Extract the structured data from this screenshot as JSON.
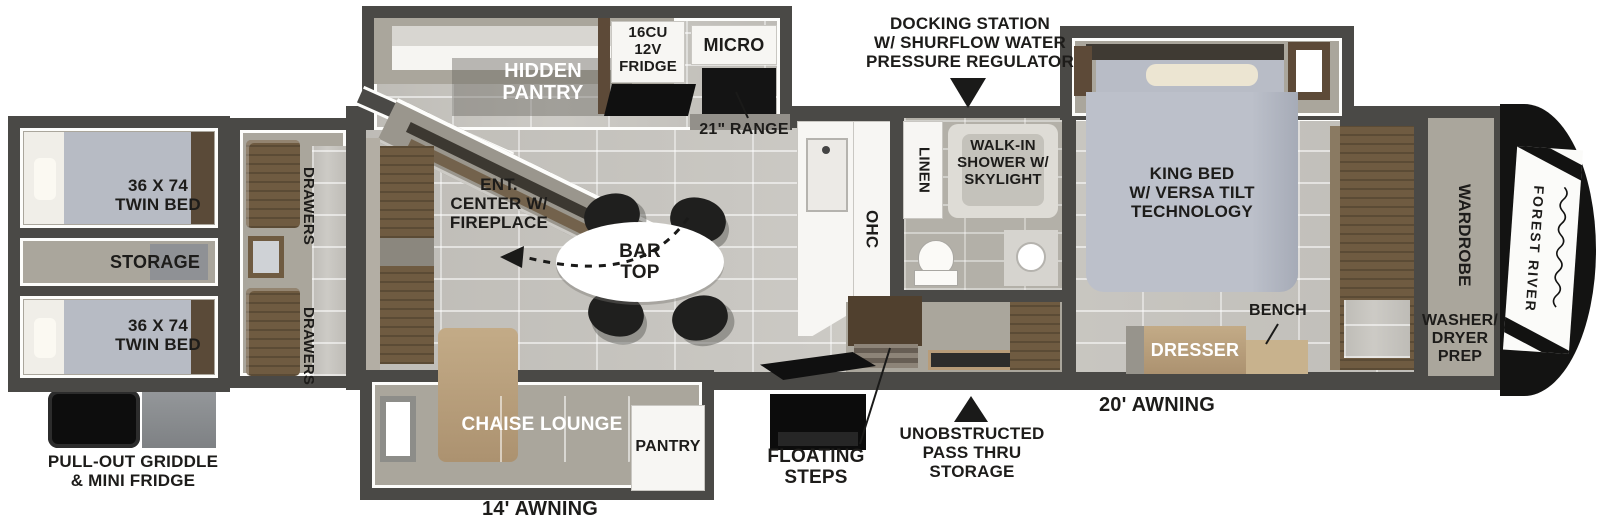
{
  "palette": {
    "wall": "#4a4946",
    "floor_tile": "#c7c5c0",
    "slide_floor": "#aaa69c",
    "wood": "#6f5b41",
    "tan_upholstery": "#b89c78",
    "mattress": "#b7bbc4",
    "appliance_black": "#121212",
    "label_black": "#1d1c1a",
    "label_white": "#ffffff"
  },
  "labels": {
    "twin_bed_top": "36 X 74\nTWIN BED",
    "storage": "STORAGE",
    "twin_bed_bottom": "36 X 74\nTWIN BED",
    "drawers_top": "DRAWERS",
    "drawers_bottom": "DRAWERS",
    "griddle": "PULL-OUT GRIDDLE\n& MINI FRIDGE",
    "hidden_pantry": "HIDDEN\nPANTRY",
    "fridge": "16CU\n12V\nFRIDGE",
    "micro": "MICRO",
    "range": "21\" RANGE",
    "ent_center": "ENT.\nCENTER W/\nFIREPLACE",
    "bar_top": "BAR\nTOP",
    "ohc": "OHC",
    "docking": "DOCKING STATION\nW/ SHURFLOW WATER\nPRESSURE REGULATOR",
    "linen": "LINEN",
    "shower": "WALK-IN\nSHOWER W/\nSKYLIGHT",
    "king_bed": "KING BED\nW/ VERSA TILT\nTECHNOLOGY",
    "bench": "BENCH",
    "dresser": "DRESSER",
    "wardrobe": "WARDROBE",
    "washer_dryer": "WASHER/\nDRYER\nPREP",
    "brand": "FOREST RIVER",
    "chaise": "CHAISE LOUNGE",
    "pantry": "PANTRY",
    "awning_rear": "14' AWNING",
    "awning_front": "20' AWNING",
    "floating_steps": "FLOATING\nSTEPS",
    "pass_thru": "UNOBSTRUCTED\nPASS THRU\nSTORAGE"
  }
}
